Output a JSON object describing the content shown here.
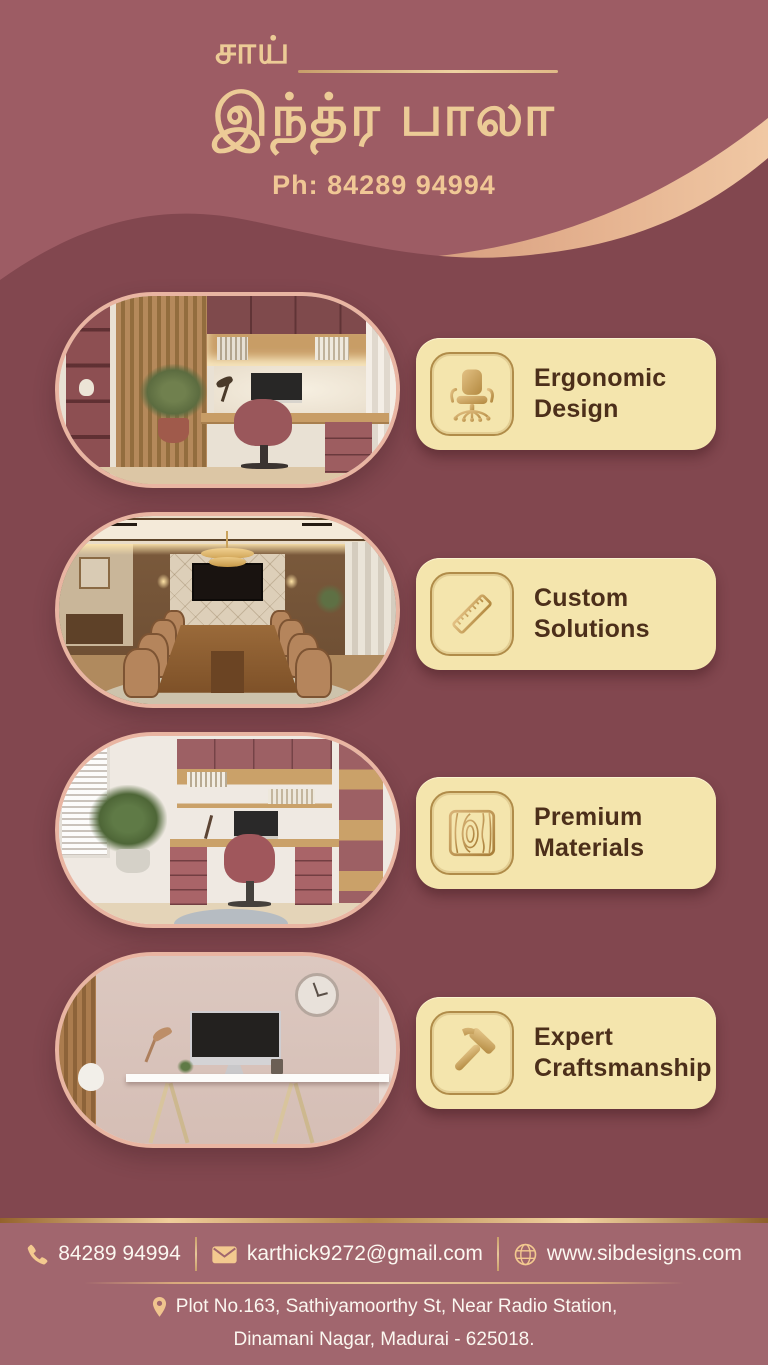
{
  "header": {
    "title_top": "சாய்",
    "title_main": "இந்த்ர பாலா",
    "phone_label": "Ph: 84289 94994"
  },
  "features": [
    {
      "label": "Ergonomic Design",
      "icon": "office-chair-icon"
    },
    {
      "label": "Custom Solutions",
      "icon": "ruler-icon"
    },
    {
      "label": "Premium Materials",
      "icon": "wood-grain-icon"
    },
    {
      "label": "Expert Craftsmanship",
      "icon": "hammer-icon"
    }
  ],
  "gallery": [
    {
      "name": "maroon-home-office-photo"
    },
    {
      "name": "conference-room-photo"
    },
    {
      "name": "light-home-office-photo"
    },
    {
      "name": "minimal-desk-photo"
    }
  ],
  "footer": {
    "phone": "84289 94994",
    "email": "karthick9272@gmail.com",
    "website": "www.sibdesigns.com",
    "address_line1": "Plot No.163, Sathiyamoorthy St, Near Radio Station,",
    "address_line2": "Dinamani Nagar, Madurai - 625018."
  },
  "colors": {
    "bg_top": "#9d5c64",
    "bg_body": "#82474f",
    "accent_gold": "#eccb96",
    "stripe_tan": "#e0a987",
    "badge_bg": "#f4e5ad",
    "badge_text": "#4c2f1a",
    "card_border": "#e9b5a2",
    "footer_band": "#a1666e",
    "footer_text": "#fbf7f0"
  }
}
